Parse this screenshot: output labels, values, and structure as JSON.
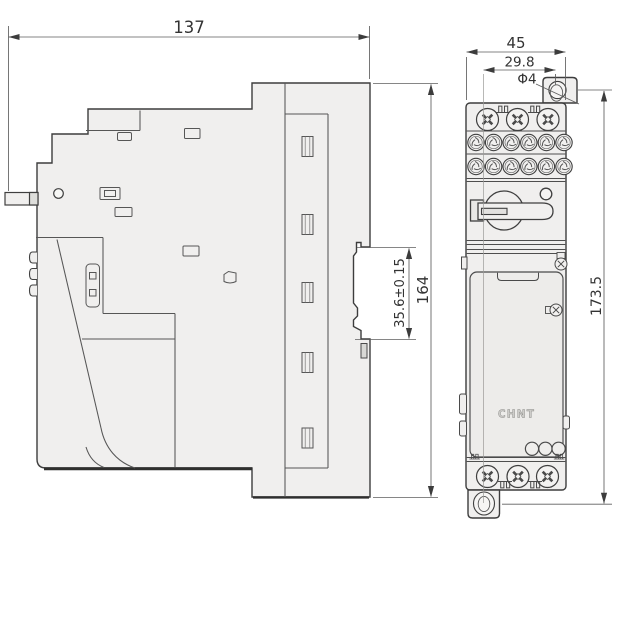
{
  "dimensions": {
    "side_overall_width": "137",
    "side_overall_height": "164",
    "din_notch_height": "35.6±0.15",
    "front_overall_width": "45",
    "mount_hole_offset": "29.8",
    "mount_hole_diameter": "Φ4",
    "mount_hole_span_height": "173.5"
  },
  "branding": {
    "logo_text": "CHNT"
  },
  "colors": {
    "background": "#ffffff",
    "body_fill": "#f0efee",
    "panel_fill": "#edecea",
    "outline": "#3d3d3d",
    "dimension_line": "#5f5f5f",
    "dimension_text": "#333333"
  }
}
